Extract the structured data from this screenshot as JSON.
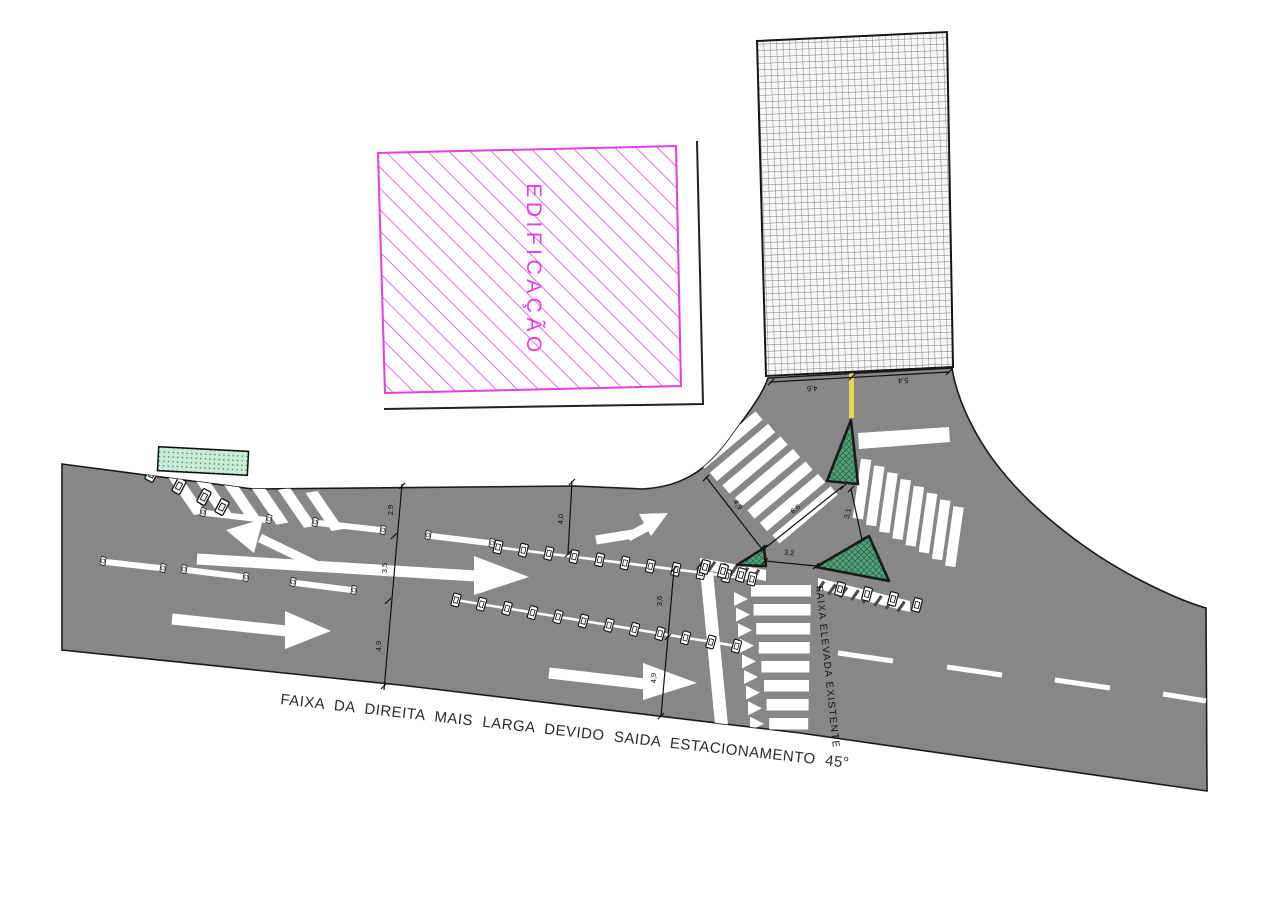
{
  "diagram": {
    "type": "traffic-engineering-site-plan",
    "labels": {
      "building": "EDIFICAÇÃO",
      "raised_crosswalk": "FAIXA ELEVADA EXISTENTE",
      "note": "FAIXA DA DIREITA MAIS LARGA DEVIDO SAIDA ESTACIONAMENTO 45°"
    },
    "dimensions": {
      "street": [
        "4,6",
        "5,4"
      ],
      "section1": [
        "2,9",
        "3,5",
        "4,9"
      ],
      "section2": [
        "4,0",
        "3,6",
        "4,9"
      ],
      "crosswalk_left_length": "4,9",
      "island_edge": "6,6",
      "crosswalk_right_width": "3,1",
      "island_gap": "3,2"
    },
    "colors": {
      "road": "#878787",
      "marking": "#FFFFFF",
      "island_green": "#53A07A",
      "island_hatch": "#2B6B4F",
      "parklet_green": "#CBEBD8",
      "parklet_dot": "#2F8C60",
      "building_magenta": "#E33FE3",
      "center_line_yellow": "#E8D44D",
      "outline": "#1A1A1A"
    }
  }
}
